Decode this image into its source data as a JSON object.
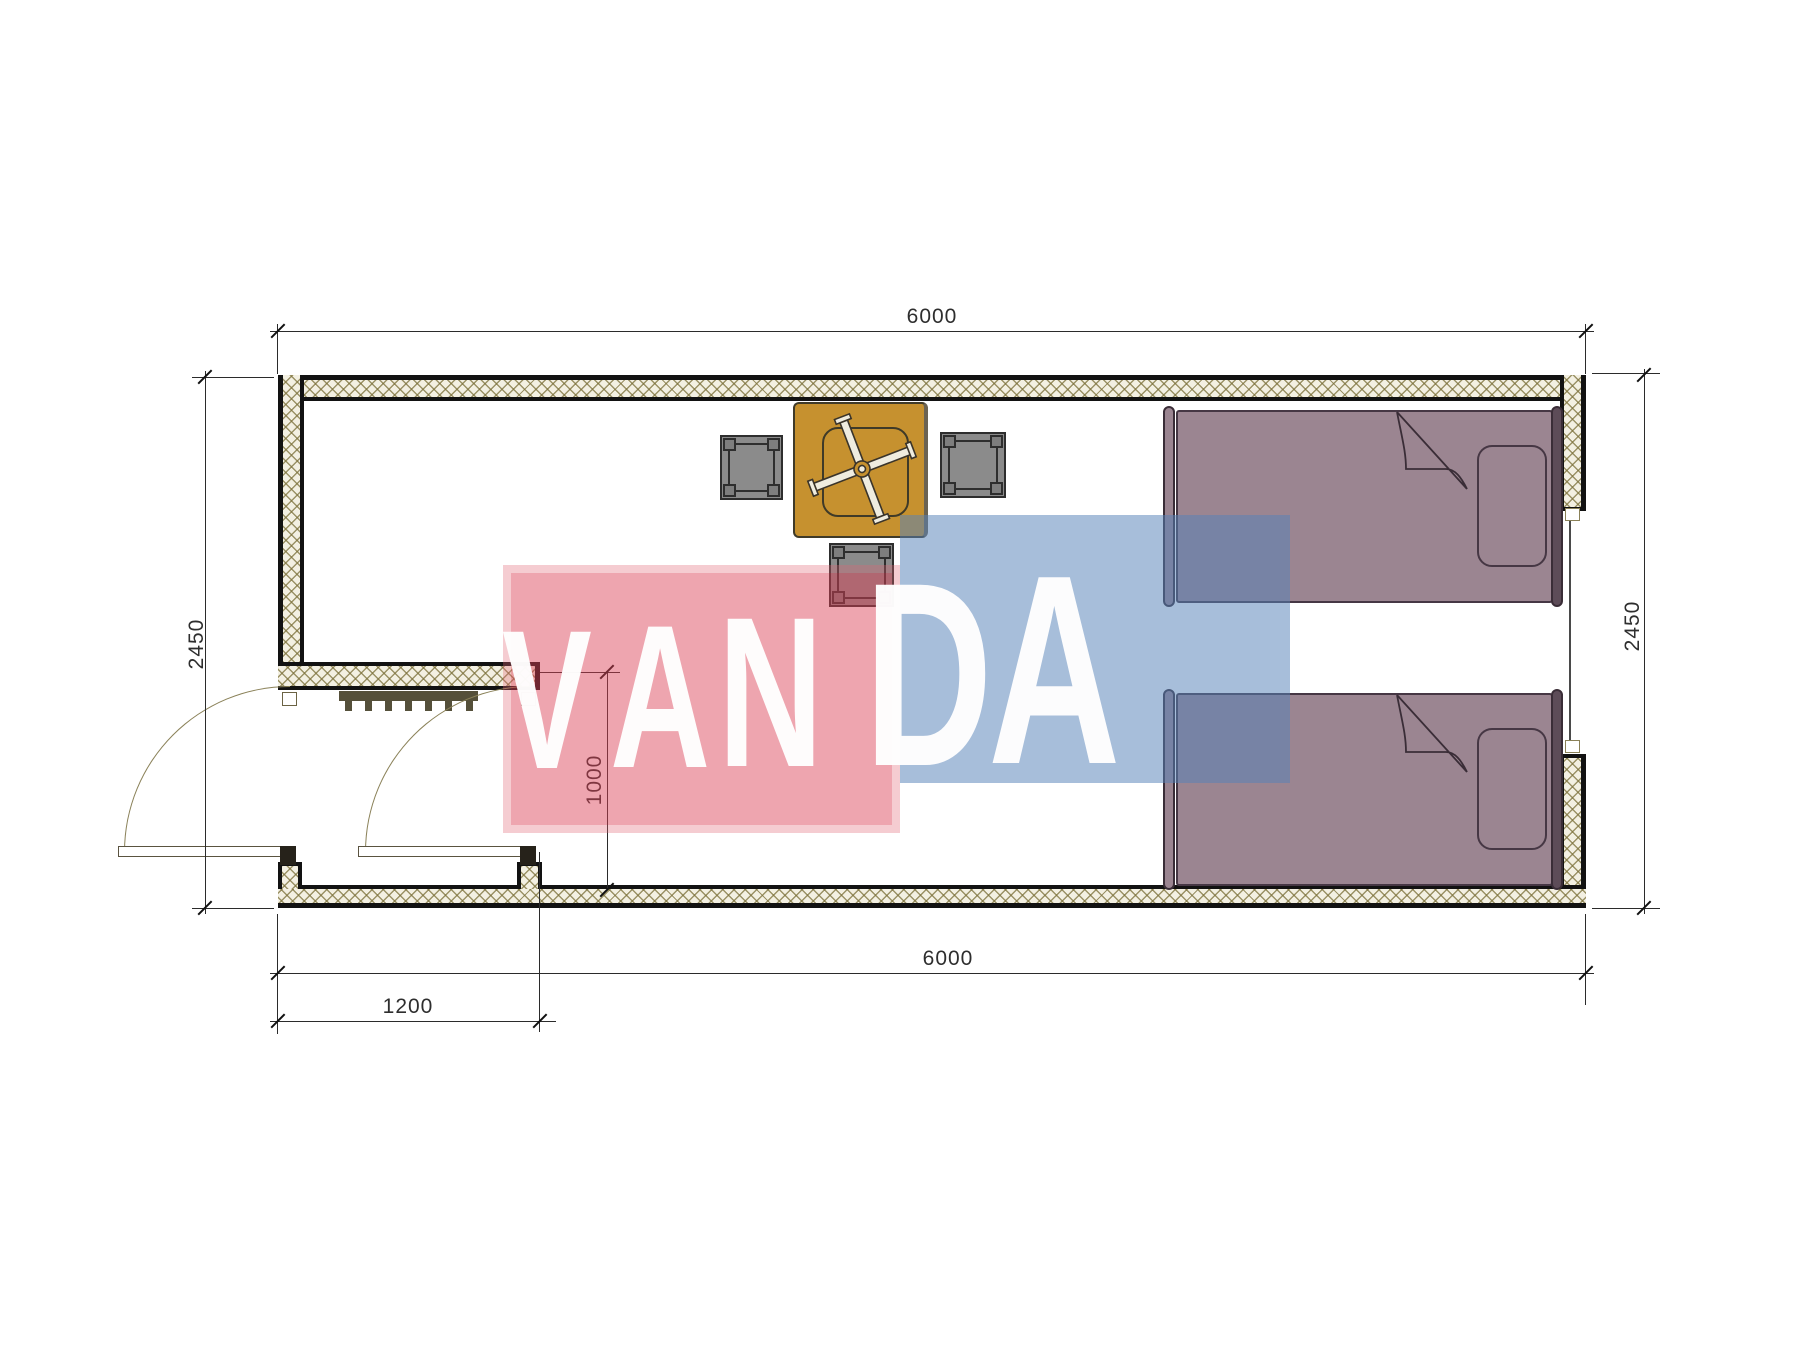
{
  "title": "container-cabin-floor-plan",
  "dimensions": {
    "top": "6000",
    "bottom": "6000",
    "left": "2450",
    "right": "2450",
    "door_bay": "1200",
    "entry_depth": "1000"
  },
  "watermark": {
    "text": "VANDA",
    "red_block_color": "rgba(219,64,86,0.47)",
    "red_block_halo": "rgba(224,100,116,0.33)",
    "blue_block_color": "rgba(86,130,185,0.52)",
    "text_color": "#ffffff"
  },
  "palette": {
    "wall_fill": "#f3f0e2",
    "wall_hatch_line": "#7d723c",
    "wall_edge": "#121212",
    "table": "#c6912f",
    "stool": "#8b8b8b",
    "bed": "#9b8591",
    "bed_outline": "#463744",
    "door_line": "#8a8158"
  },
  "symbols": {
    "table": "square-table-with-fan",
    "stools": [
      "stool",
      "stool",
      "stool"
    ],
    "beds": [
      "single-bed",
      "single-bed"
    ],
    "door": "double-outswing-entry-door",
    "window": "window-in-right-wall",
    "mat": "entry-doormat"
  }
}
